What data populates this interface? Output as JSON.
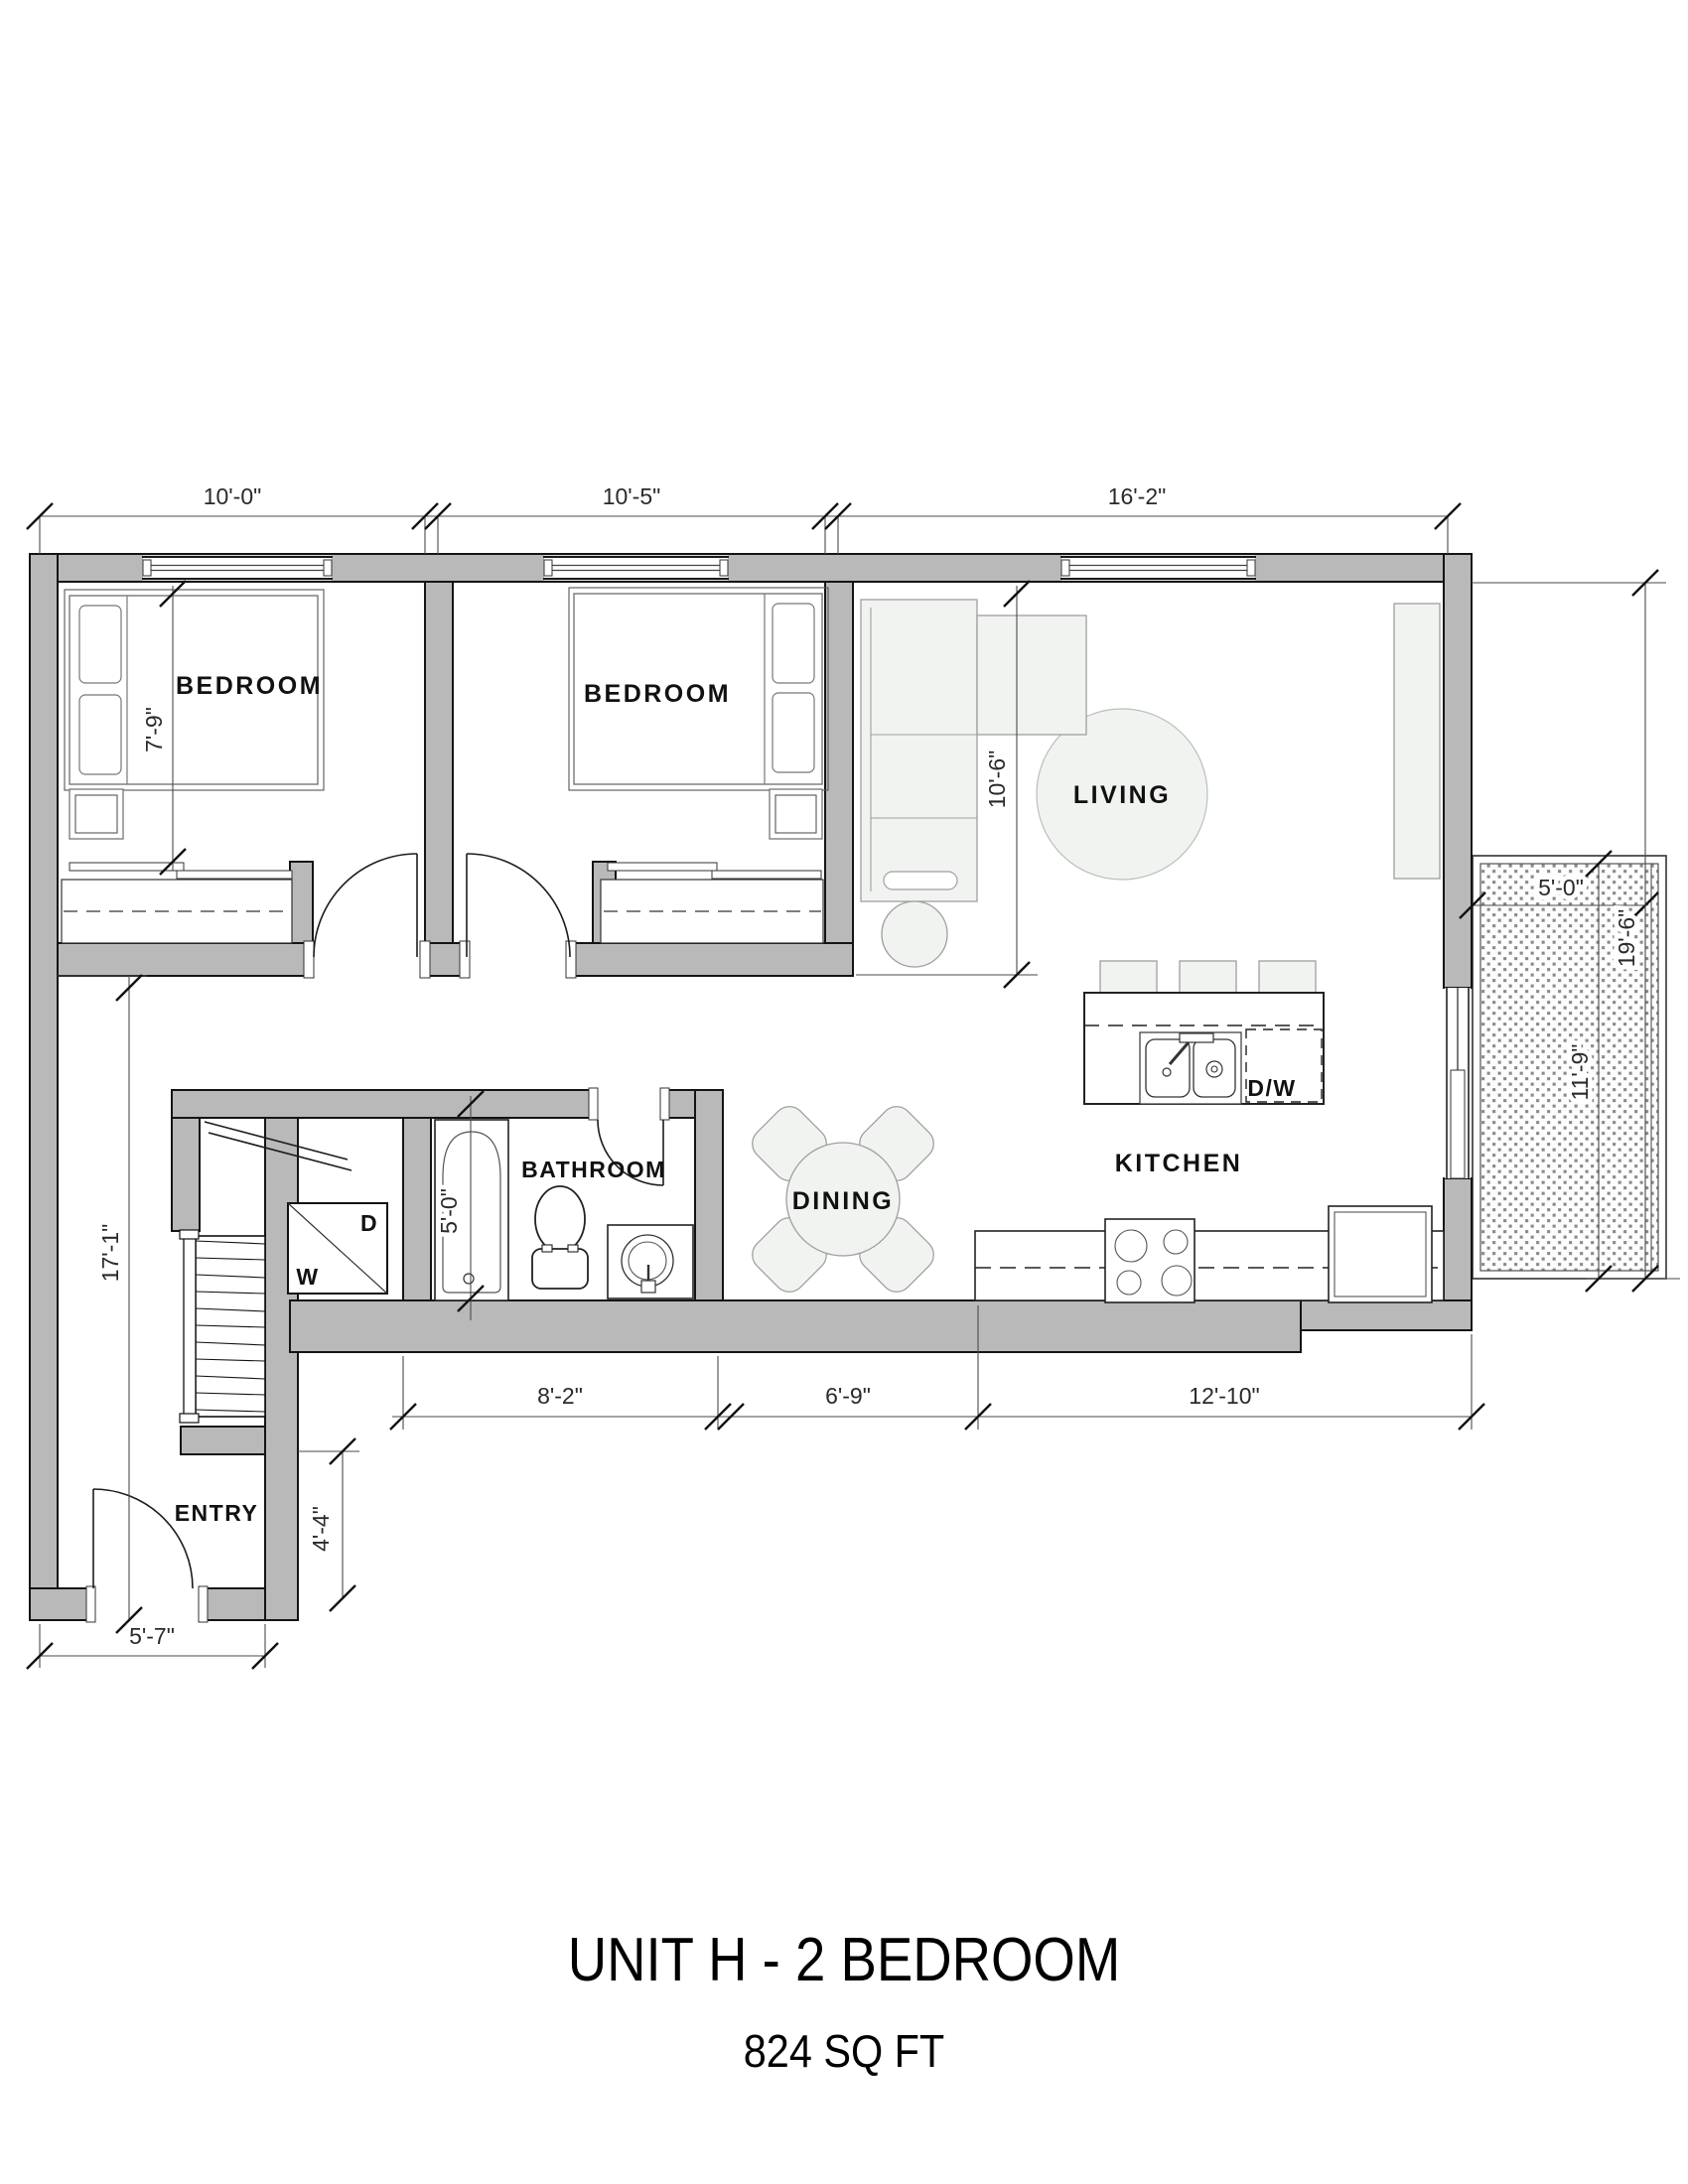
{
  "title": {
    "line1": "UNIT H - 2 BEDROOM",
    "line2": "824 SQ FT"
  },
  "rooms": {
    "bedroom1": "BEDROOM",
    "bedroom2": "BEDROOM",
    "living": "LIVING",
    "dining": "DINING",
    "kitchen": "KITCHEN",
    "bathroom": "BATHROOM",
    "entry": "ENTRY"
  },
  "appliances": {
    "washer": "W",
    "dryer": "D",
    "dishwasher": "D/W"
  },
  "dimensions": {
    "top": [
      "10'-0\"",
      "10'-5\"",
      "16'-2\""
    ],
    "bottom": [
      "8'-2\"",
      "6'-9\"",
      "12'-10\""
    ],
    "bedroom1_depth": "7'-9\"",
    "living_depth": "10'-6\"",
    "tub_length": "5'-0\"",
    "left_height": "17'-1\"",
    "entry_notch": "4'-4\"",
    "entry_width": "5'-7\"",
    "balcony_width": "5'-0\"",
    "balcony_length": "11'-9\"",
    "right_height": "19'-6\""
  },
  "colors": {
    "wall": "#b9b9b9",
    "outline": "#141414",
    "furniture_fill": "#f1f3f1",
    "furniture_stroke": "#9f9f9f",
    "hatch_dot": "#8a8a8a",
    "dim_text": "#2a2a2a"
  }
}
